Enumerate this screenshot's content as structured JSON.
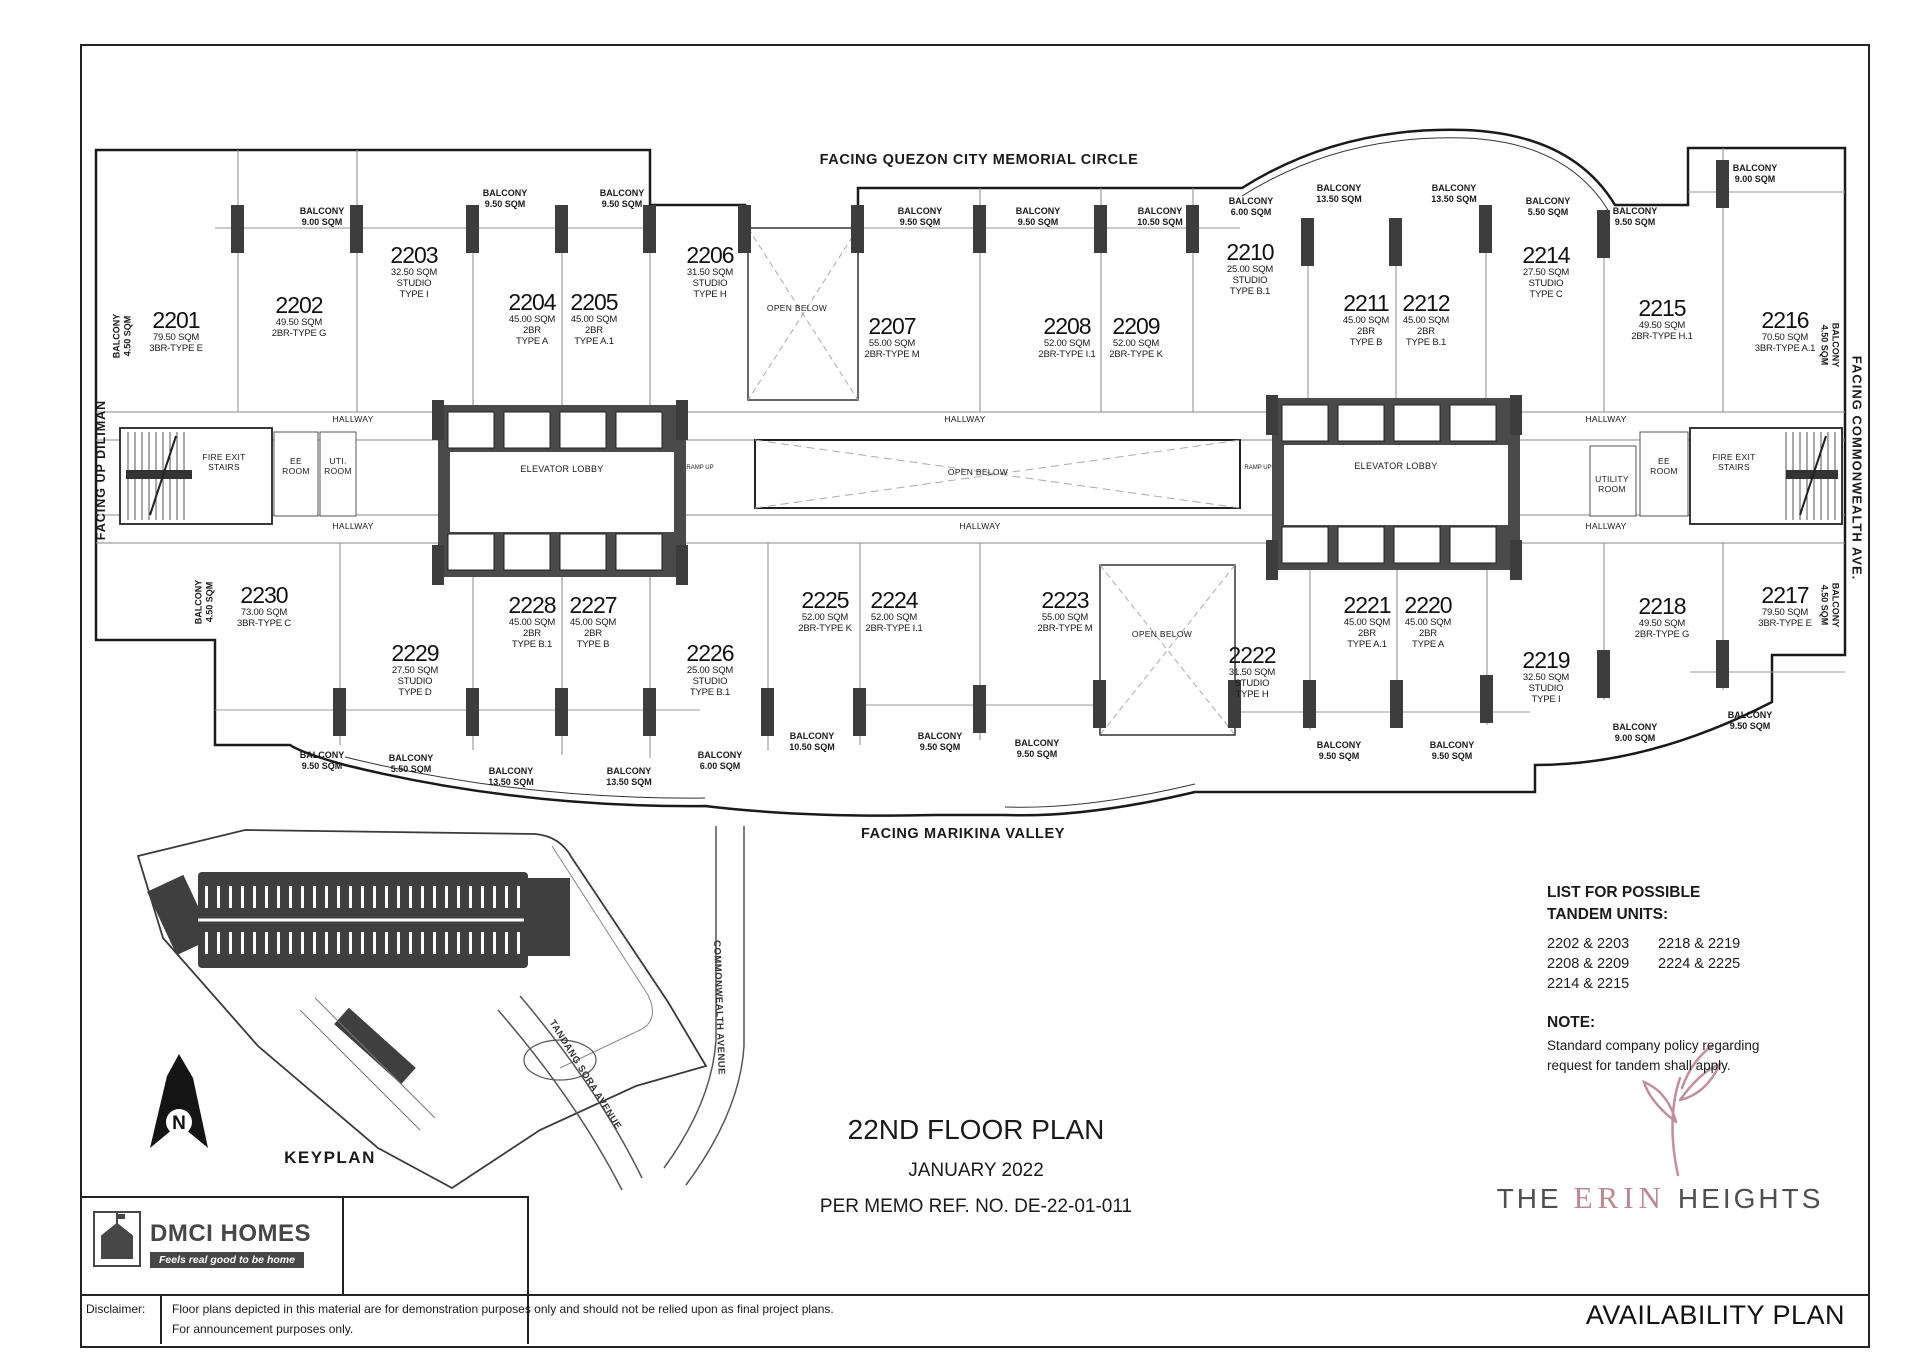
{
  "header": {
    "facing_top": "FACING QUEZON CITY MEMORIAL CIRCLE",
    "facing_bottom": "FACING MARIKINA VALLEY",
    "facing_left": "FACING UP DILIMAN",
    "facing_right": "FACING COMMONWEALTH AVE."
  },
  "plan": {
    "labels": {
      "balcony": "BALCONY",
      "hallway": "HALLWAY",
      "elevator_lobby": "ELEVATOR LOBBY",
      "open_below": "OPEN BELOW",
      "fire_exit_stairs": "FIRE EXIT STAIRS",
      "ee_room": "EE ROOM",
      "uti_room": "UTI. ROOM",
      "utility_room": "UTILITY ROOM",
      "ramp_up": "RAMP UP"
    },
    "units": [
      {
        "no": "2201",
        "l1": "79.50 SQM",
        "l2": "3BR-TYPE E",
        "l3": ""
      },
      {
        "no": "2202",
        "l1": "49.50 SQM",
        "l2": "2BR-TYPE G",
        "l3": ""
      },
      {
        "no": "2203",
        "l1": "32.50 SQM",
        "l2": "STUDIO",
        "l3": "TYPE I"
      },
      {
        "no": "2204",
        "l1": "45.00 SQM",
        "l2": "2BR",
        "l3": "TYPE A"
      },
      {
        "no": "2205",
        "l1": "45.00 SQM",
        "l2": "2BR",
        "l3": "TYPE A.1"
      },
      {
        "no": "2206",
        "l1": "31.50 SQM",
        "l2": "STUDIO",
        "l3": "TYPE H"
      },
      {
        "no": "2207",
        "l1": "55.00 SQM",
        "l2": "2BR-TYPE M",
        "l3": ""
      },
      {
        "no": "2208",
        "l1": "52.00 SQM",
        "l2": "2BR-TYPE I.1",
        "l3": ""
      },
      {
        "no": "2209",
        "l1": "52.00 SQM",
        "l2": "2BR-TYPE K",
        "l3": ""
      },
      {
        "no": "2210",
        "l1": "25.00 SQM",
        "l2": "STUDIO",
        "l3": "TYPE B.1"
      },
      {
        "no": "2211",
        "l1": "45.00 SQM",
        "l2": "2BR",
        "l3": "TYPE B"
      },
      {
        "no": "2212",
        "l1": "45.00 SQM",
        "l2": "2BR",
        "l3": "TYPE B.1"
      },
      {
        "no": "2214",
        "l1": "27.50 SQM",
        "l2": "STUDIO",
        "l3": "TYPE C"
      },
      {
        "no": "2215",
        "l1": "49.50 SQM",
        "l2": "2BR-TYPE H.1",
        "l3": ""
      },
      {
        "no": "2216",
        "l1": "70.50 SQM",
        "l2": "3BR-TYPE A.1",
        "l3": ""
      },
      {
        "no": "2217",
        "l1": "79.50 SQM",
        "l2": "3BR-TYPE E",
        "l3": ""
      },
      {
        "no": "2218",
        "l1": "49.50 SQM",
        "l2": "2BR-TYPE G",
        "l3": ""
      },
      {
        "no": "2219",
        "l1": "32.50 SQM",
        "l2": "STUDIO",
        "l3": "TYPE I"
      },
      {
        "no": "2220",
        "l1": "45.00 SQM",
        "l2": "2BR",
        "l3": "TYPE A"
      },
      {
        "no": "2221",
        "l1": "45.00 SQM",
        "l2": "2BR",
        "l3": "TYPE A.1"
      },
      {
        "no": "2222",
        "l1": "31.50 SQM",
        "l2": "STUDIO",
        "l3": "TYPE H"
      },
      {
        "no": "2223",
        "l1": "55.00 SQM",
        "l2": "2BR-TYPE M",
        "l3": ""
      },
      {
        "no": "2224",
        "l1": "52.00 SQM",
        "l2": "2BR-TYPE I.1",
        "l3": ""
      },
      {
        "no": "2225",
        "l1": "52.00 SQM",
        "l2": "2BR-TYPE K",
        "l3": ""
      },
      {
        "no": "2226",
        "l1": "25.00 SQM",
        "l2": "STUDIO",
        "l3": "TYPE B.1"
      },
      {
        "no": "2227",
        "l1": "45.00 SQM",
        "l2": "2BR",
        "l3": "TYPE B"
      },
      {
        "no": "2228",
        "l1": "45.00 SQM",
        "l2": "2BR",
        "l3": "TYPE B.1"
      },
      {
        "no": "2229",
        "l1": "27.50 SQM",
        "l2": "STUDIO",
        "l3": "TYPE D"
      },
      {
        "no": "2230",
        "l1": "73.00 SQM",
        "l2": "3BR-TYPE C",
        "l3": ""
      }
    ],
    "balconies": [
      "4.50 SQM",
      "9.00 SQM",
      "9.50 SQM",
      "9.50 SQM",
      "9.50 SQM",
      "9.50 SQM",
      "10.50 SQM",
      "6.00 SQM",
      "13.50 SQM",
      "13.50 SQM",
      "5.50 SQM",
      "9.50 SQM",
      "9.00 SQM",
      "4.50 SQM",
      "4.50 SQM",
      "9.50 SQM",
      "5.50 SQM",
      "13.50 SQM",
      "13.50 SQM",
      "6.00 SQM",
      "10.50 SQM",
      "9.50 SQM",
      "9.50 SQM",
      "9.50 SQM",
      "9.50 SQM",
      "9.00 SQM",
      "9.50 SQM",
      "4.50 SQM"
    ]
  },
  "tandem": {
    "title1": "LIST FOR POSSIBLE",
    "title2": "TANDEM UNITS:",
    "pairs_col1": [
      "2202 & 2203",
      "2208 & 2209",
      "2214 & 2215"
    ],
    "pairs_col2": [
      "2218 & 2219",
      "2224 & 2225"
    ],
    "note_title": "NOTE:",
    "note1": "Standard company policy regarding",
    "note2": "request for tandem shall apply."
  },
  "title_block": {
    "floor": "22ND FLOOR PLAN",
    "date": "JANUARY 2022",
    "memo": "PER MEMO REF. NO. DE-22-01-011"
  },
  "keyplan": {
    "label": "KEYPLAN",
    "road1": "COMMONWEALTH AVENUE",
    "road2": "TANDANG SORA AVENUE",
    "north": "N"
  },
  "branding": {
    "dmci": "DMCI HOMES",
    "tagline": "Feels real good to be home",
    "the": "THE",
    "erin": "ERIN",
    "heights": "HEIGHTS",
    "availability": "AVAILABILITY PLAN",
    "accent": "#bb8894"
  },
  "disclaimer": {
    "label": "Disclaimer:",
    "line1": "Floor plans depicted in this material are for demonstration purposes only and should not be relied upon as final project plans.",
    "line2": "For announcement purposes only."
  }
}
